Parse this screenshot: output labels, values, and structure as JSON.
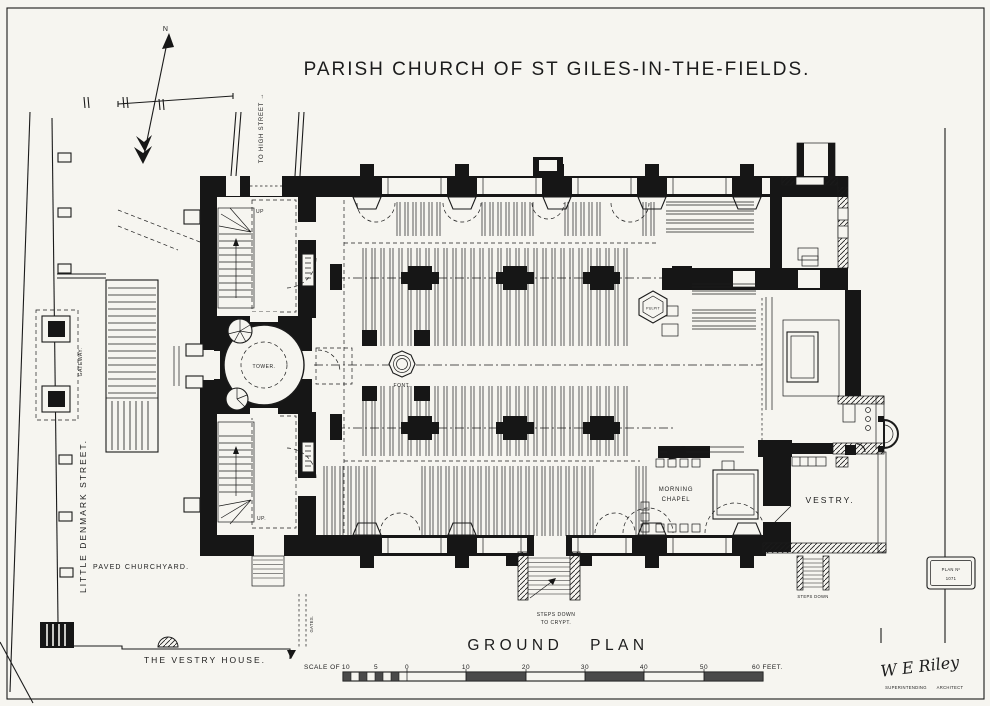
{
  "title": "PARISH CHURCH OF ST GILES-IN-THE-FIELDS.",
  "compass": {
    "north": "N"
  },
  "streets": {
    "to_high_street": "TO HIGH STREET →",
    "little_denmark": "LITTLE DENMARK STREET.",
    "gateway": "GATEWAY.",
    "gates": "GATES."
  },
  "site": {
    "paved_churchyard": "PAVED CHURCHYARD.",
    "vestry_house": "THE VESTRY HOUSE."
  },
  "rooms": {
    "tower": "TOWER.",
    "font": "FONT.",
    "pulpit": "PULPIT",
    "morning_chapel_line1": "MORNING",
    "morning_chapel_line2": "CHAPEL",
    "vestry": "VESTRY.",
    "up_northwest": "UP",
    "up_southwest": "UP.",
    "crypt_steps_line1": "STEPS DOWN",
    "crypt_steps_line2": "TO CRYPT.",
    "vestry_steps": "STEPS DOWN"
  },
  "footer": {
    "ground_plan": "GROUND PLAN",
    "scale_prefix": "SCALE OF",
    "scale_ticks": [
      "10",
      "5",
      "0",
      "10",
      "20",
      "30",
      "40",
      "50"
    ],
    "scale_unit": "60 FEET.",
    "signature": "W E Riley",
    "signature_role_line1": "SUPERINTENDING",
    "signature_role_line2": "ARCHITECT",
    "stamp_line1": "PLAN Nº",
    "stamp_line2": "1071"
  }
}
